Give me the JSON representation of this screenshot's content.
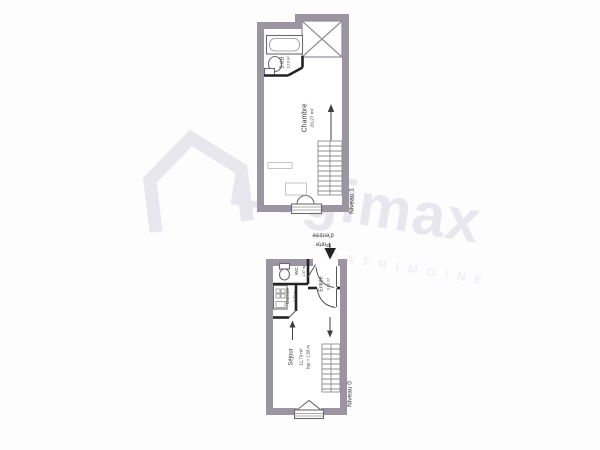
{
  "watermark": {
    "brand": "Logimax",
    "tagline": "PATRIMOINE"
  },
  "levels": {
    "level1": {
      "name": "Niveau 1",
      "chambre": {
        "label": "Chambre",
        "area": "20,27 m²"
      },
      "sdb": {
        "label": "S.d.B.",
        "area": "3,19 m²"
      }
    },
    "level0": {
      "name": "Niveau 0",
      "entrance": {
        "line1": "Porte",
        "line2": "d'entrée"
      },
      "wc": {
        "label": "WC",
        "area": "1,57 m²"
      },
      "cuisine": {
        "label": "Cuisine",
        "area": "2,73 m²"
      },
      "entree": {
        "label": "Entrée",
        "area": "3,92 m²"
      },
      "sejour": {
        "label": "Séjour",
        "area": "11,73 m²",
        "ceiling": "hsp = 2,58 m"
      }
    }
  },
  "colors": {
    "wall": "#9b95a1",
    "partition": "#232323",
    "fixture": "#6a6a6a",
    "label": "#3a3a3a",
    "watermark": "#e9e7ee"
  }
}
